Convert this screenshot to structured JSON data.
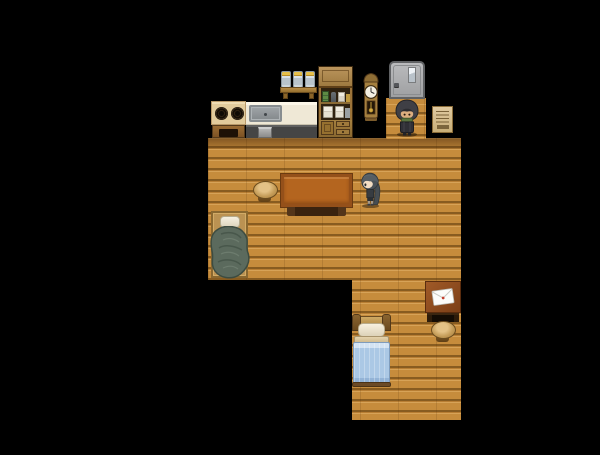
{
  "viewport": {
    "width": 600,
    "height": 455,
    "background_color": "#000000"
  },
  "scene": {
    "type": "top-down RPG house interior",
    "floors": {
      "main": {
        "label": "Wooden plank floor (main room)"
      },
      "entry": {
        "label": "Entry floor strip by the door"
      },
      "lower": {
        "label": "Wooden plank floor (bedroom nook)"
      }
    },
    "kitchen": {
      "stove": {
        "label": "Stove with two burners"
      },
      "counter": {
        "label": "Kitchen counter"
      },
      "sink": {
        "label": "Metal sink"
      },
      "trash_bin": {
        "label": "Small metal bin"
      },
      "jar_shelf": {
        "label": "Wooden stand with three glass jars"
      },
      "cupboard": {
        "label": "Kitchen cupboard with shelves of jars and canisters"
      },
      "clock": {
        "label": "Grandfather wall clock"
      },
      "door": {
        "label": "Gray metal door"
      },
      "wall_note": {
        "label": "Paper note pinned to the wall"
      }
    },
    "living_area": {
      "table": {
        "label": "Large wooden table"
      },
      "stool_left": {
        "label": "Round wooden stool"
      },
      "bedroll": {
        "label": "Bedroll with white pillow and green blanket"
      }
    },
    "bedroom": {
      "bed": {
        "label": "Bed with blue blanket"
      },
      "mail_table": {
        "label": "Dark side table with an envelope"
      },
      "envelope": {
        "label": "White envelope with red seal"
      },
      "stool_right": {
        "label": "Round wooden stool"
      }
    },
    "characters": {
      "hooded_npc": {
        "label": "Hooded figure with green scarf standing by the door"
      },
      "girl": {
        "label": "Girl with long dark hair standing beside the table"
      }
    }
  },
  "colors": {
    "wall": "#000000",
    "floor_wood": "#c68c3c",
    "plank_line": "#8a5c20",
    "table_top": "#b4651f",
    "bed_blanket_blue": "#abc8e5",
    "bedroll_blanket_green": "#5b6a5d",
    "door_gray": "#a9aaac",
    "note_paper": "#d9c08a",
    "mail_table_top": "#8a4a20",
    "scarf_green": "#5a7440",
    "girl_hair": "#4b5257"
  }
}
